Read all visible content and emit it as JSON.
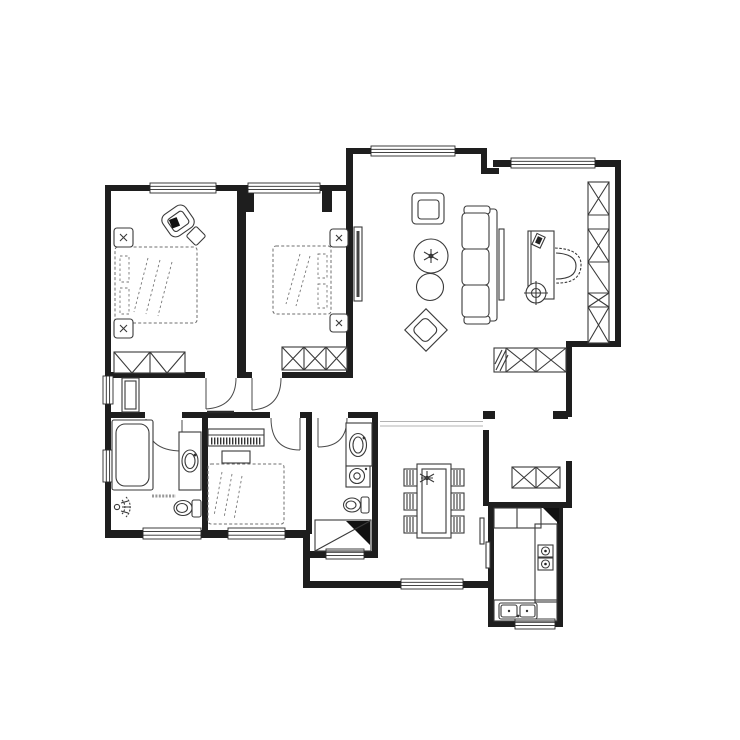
{
  "title": "Residential apartment floor plan (black-and-white CAD line drawing)",
  "canvas": {
    "width": 740,
    "height": 740
  },
  "colors": {
    "background": "#ffffff",
    "wall": "#1e1e1e",
    "furniture_line": "#3a3a3a",
    "dashed_line": "#6f6f6f",
    "solid_fill": "#111111",
    "beam_line": "#9a9a9a"
  },
  "rooms": [
    {
      "id": "master-bedroom",
      "position": "top-left",
      "furniture": [
        "double-bed (dashed)",
        "nightstand x2",
        "lounge-chair",
        "side-table",
        "wardrobe",
        "tall-cabinet"
      ]
    },
    {
      "id": "bedroom-2",
      "position": "top-middle",
      "furniture": [
        "double-bed (dashed)",
        "nightstand x2",
        "wardrobe-3-section"
      ]
    },
    {
      "id": "living-room",
      "position": "center",
      "furniture": [
        "tv-panel",
        "armchair",
        "sofa-3-seat",
        "round-coffee-table-large",
        "round-coffee-table-small",
        "diamond-ottoman"
      ]
    },
    {
      "id": "study",
      "position": "top-right",
      "furniture": [
        "desk",
        "desk-gadget",
        "office-chair",
        "bookshelf-wall-unit",
        "round-lamp-symbol",
        "sideboard-cabinet"
      ]
    },
    {
      "id": "hallway",
      "position": "center-left",
      "furniture": [
        "storage-cabinet"
      ]
    },
    {
      "id": "master-bathroom",
      "position": "bottom-left",
      "furniture": [
        "bathtub",
        "vanity-sink",
        "toilet",
        "shower-head-symbol"
      ]
    },
    {
      "id": "bedroom-3",
      "position": "bottom-middle",
      "furniture": [
        "bed (dashed)",
        "slatted-dresser",
        "bench"
      ]
    },
    {
      "id": "bathroom-2",
      "position": "center-bottom",
      "furniture": [
        "vanity-sink",
        "washing-machine",
        "toilet",
        "shower-corner"
      ]
    },
    {
      "id": "dining-room",
      "position": "bottom-center",
      "furniture": [
        "dining-table",
        "dining-chair x6",
        "table-plant"
      ]
    },
    {
      "id": "kitchen",
      "position": "bottom-right",
      "furniture": [
        "counter-run",
        "corner-counter-fill",
        "cooktop-2-burner",
        "double-basin-sink",
        "sliding-door"
      ]
    },
    {
      "id": "entry-corridor",
      "position": "right",
      "furniture": [
        "shoe-cabinet"
      ]
    }
  ],
  "openings": {
    "windows": 11,
    "interior_door_arcs": 5,
    "entry_opening": 1
  },
  "annotations": {
    "tiny_illegible_label_present": true
  }
}
